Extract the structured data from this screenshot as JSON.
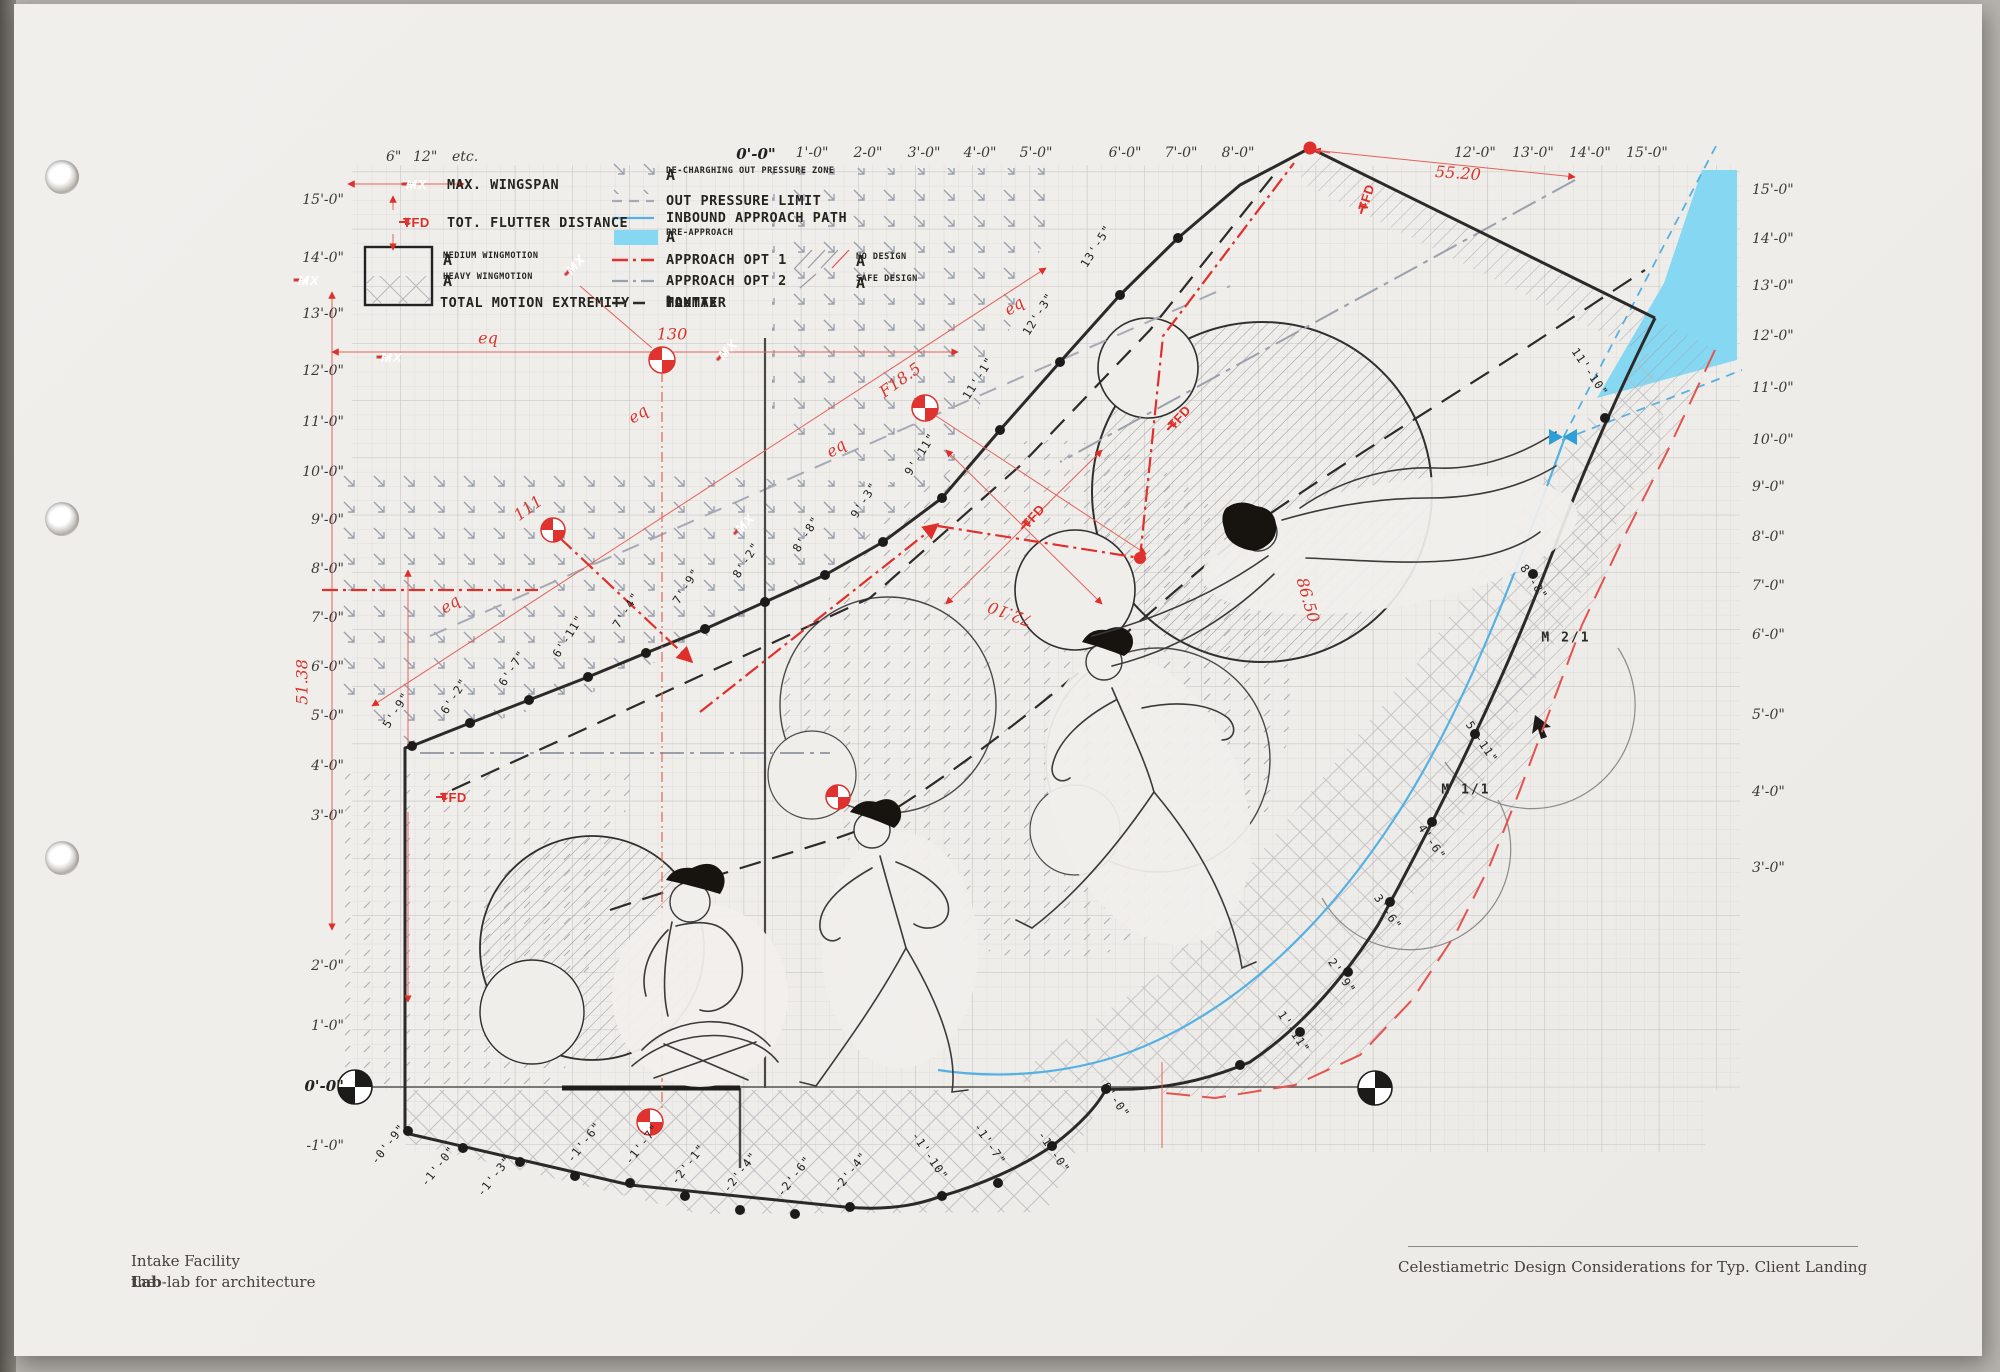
{
  "titleblock": {
    "project": "Intake Facility",
    "firm_prefix": "the",
    "firm_bold": "Lab",
    "firm_suffix": "-lab for architecture",
    "sheet_caption": "Celestiametric Design Considerations for Typ. Client Landing"
  },
  "legend": {
    "scale_note": [
      "6\"",
      "12\"",
      "etc."
    ],
    "stamp_mx": "MX",
    "stamp_tfd": "TFD",
    "tfd_arrow": "⇅",
    "arrow_left": "←",
    "arrow_right": "→",
    "rows_left": [
      {
        "label": "MAX. WINGSPAN"
      },
      {
        "label": "TOT. FLUTTER DISTANCE"
      },
      {
        "a": "A",
        "sub": "MEDIUM WINGMOTION"
      },
      {
        "a": "A",
        "sub": "HEAVY WINGMOTION"
      },
      {
        "label": "TOTAL MOTION EXTREMITY"
      }
    ],
    "rows_mid": [
      {
        "a": "A",
        "sub": "DE-CHARGHING OUT PRESSURE ZONE"
      },
      {
        "label": "OUT PRESSURE LIMIT"
      },
      {
        "label": "INBOUND APPROACH PATH"
      },
      {
        "a": "A",
        "sub": "PRE-APPROACH"
      },
      {
        "label": "APPROACH OPT 1"
      },
      {
        "label": "APPROACH OPT 2"
      }
    ],
    "flutter": {
      "p1": "MAX",
      "s1": "1",
      "p2": " TO MAX",
      "s2": "2",
      "p3": " FLUTTER"
    },
    "rows_right": [
      {
        "a": "A",
        "sub": "NO DESIGN"
      },
      {
        "a": "A",
        "sub": "SAFE DESIGN"
      }
    ]
  },
  "colors": {
    "red": "#df2f2a",
    "blue_line": "#55b1e4",
    "cyan_fill": "#86d7f2",
    "gray_dash": "#a6aab6",
    "ink": "#2c2b29"
  },
  "axes": {
    "top": [
      {
        "t": "0'-0\"",
        "x": 756,
        "b": true
      },
      {
        "t": "1'-0\"",
        "x": 812
      },
      {
        "t": "2-0\"",
        "x": 868
      },
      {
        "t": "3'-0\"",
        "x": 924
      },
      {
        "t": "4'-0\"",
        "x": 980
      },
      {
        "t": "5'-0\"",
        "x": 1036
      },
      {
        "t": "6'-0\"",
        "x": 1125
      },
      {
        "t": "7'-0\"",
        "x": 1181
      },
      {
        "t": "8'-0\"",
        "x": 1238
      },
      {
        "t": "12'-0\"",
        "x": 1475
      },
      {
        "t": "13'-0\"",
        "x": 1533
      },
      {
        "t": "14'-0\"",
        "x": 1590
      },
      {
        "t": "15'-0\"",
        "x": 1647
      }
    ],
    "left": [
      {
        "t": "15'-0\"",
        "y": 200
      },
      {
        "t": "14'-0\"",
        "y": 258
      },
      {
        "t": "13'-0\"",
        "y": 314
      },
      {
        "t": "12'-0\"",
        "y": 371
      },
      {
        "t": "11'-0\"",
        "y": 422
      },
      {
        "t": "10'-0\"",
        "y": 472
      },
      {
        "t": "9'-0\"",
        "y": 520
      },
      {
        "t": "8'-0\"",
        "y": 569
      },
      {
        "t": "7'-0\"",
        "y": 618
      },
      {
        "t": "6'-0\"",
        "y": 667
      },
      {
        "t": "5'-0\"",
        "y": 716
      },
      {
        "t": "4'-0\"",
        "y": 766
      },
      {
        "t": "3'-0\"",
        "y": 816
      },
      {
        "t": "2'-0\"",
        "y": 966
      },
      {
        "t": "1'-0\"",
        "y": 1026
      },
      {
        "t": "0'-0\"",
        "y": 1086,
        "b": true
      },
      {
        "t": "-1'-0\"",
        "y": 1146
      }
    ],
    "right": [
      {
        "t": "15'-0\"",
        "y": 190
      },
      {
        "t": "14'-0\"",
        "y": 239
      },
      {
        "t": "13'-0\"",
        "y": 286
      },
      {
        "t": "12'-0\"",
        "y": 336
      },
      {
        "t": "11'-0\"",
        "y": 388
      },
      {
        "t": "10'-0\"",
        "y": 440
      },
      {
        "t": "9'-0\"",
        "y": 487
      },
      {
        "t": "8'-0\"",
        "y": 537
      },
      {
        "t": "7'-0\"",
        "y": 586
      },
      {
        "t": "6'-0\"",
        "y": 635
      },
      {
        "t": "5'-0\"",
        "y": 715
      },
      {
        "t": "4'-0\"",
        "y": 792
      },
      {
        "t": "3'-0\"",
        "y": 868
      }
    ]
  },
  "annotations": [
    {
      "t": "55.20",
      "x": 1458,
      "y": 173,
      "r": 4,
      "c": "red"
    },
    {
      "t": "130",
      "x": 672,
      "y": 334,
      "r": 0,
      "c": "red"
    },
    {
      "t": "111",
      "x": 528,
      "y": 508,
      "r": -36,
      "c": "red"
    },
    {
      "t": "F18.5",
      "x": 900,
      "y": 380,
      "r": -36,
      "c": "red"
    },
    {
      "t": "72.10",
      "x": 1010,
      "y": 614,
      "r": 200,
      "c": "red"
    },
    {
      "t": "86.50",
      "x": 1308,
      "y": 600,
      "r": 74,
      "c": "red"
    },
    {
      "t": "51.38",
      "x": 302,
      "y": 682,
      "r": -90,
      "c": "red"
    },
    {
      "t": "eq",
      "x": 488,
      "y": 338,
      "r": 0,
      "c": "red"
    },
    {
      "t": "eq",
      "x": 638,
      "y": 414,
      "r": -33,
      "c": "red"
    },
    {
      "t": "eq",
      "x": 836,
      "y": 448,
      "r": -33,
      "c": "red"
    },
    {
      "t": "eq",
      "x": 1014,
      "y": 306,
      "r": -33,
      "c": "red"
    },
    {
      "t": "eq",
      "x": 450,
      "y": 604,
      "r": -33,
      "c": "red"
    },
    {
      "t": "5'-9\"",
      "x": 396,
      "y": 710,
      "r": -58,
      "c": "dim"
    },
    {
      "t": "6'-2\"",
      "x": 454,
      "y": 696,
      "r": -58,
      "c": "dim"
    },
    {
      "t": "6'-7\"",
      "x": 512,
      "y": 668,
      "r": -58,
      "c": "dim"
    },
    {
      "t": "6'-11\"",
      "x": 568,
      "y": 636,
      "r": -58,
      "c": "dim"
    },
    {
      "t": "7'-4\"",
      "x": 626,
      "y": 610,
      "r": -58,
      "c": "dim"
    },
    {
      "t": "7'-9\"",
      "x": 686,
      "y": 586,
      "r": -58,
      "c": "dim"
    },
    {
      "t": "8'-2\"",
      "x": 746,
      "y": 560,
      "r": -58,
      "c": "dim"
    },
    {
      "t": "8'-8\"",
      "x": 806,
      "y": 534,
      "r": -58,
      "c": "dim"
    },
    {
      "t": "9'-3\"",
      "x": 864,
      "y": 500,
      "r": -58,
      "c": "dim"
    },
    {
      "t": "9'-11\"",
      "x": 920,
      "y": 454,
      "r": -58,
      "c": "dim"
    },
    {
      "t": "11'-1\"",
      "x": 978,
      "y": 378,
      "r": -58,
      "c": "dim"
    },
    {
      "t": "12'-3\"",
      "x": 1038,
      "y": 314,
      "r": -58,
      "c": "dim"
    },
    {
      "t": "13'-5\"",
      "x": 1096,
      "y": 246,
      "r": -58,
      "c": "dim"
    },
    {
      "t": "11'-10\"",
      "x": 1590,
      "y": 372,
      "r": 56,
      "c": "dim"
    },
    {
      "t": "8'-8\"",
      "x": 1534,
      "y": 582,
      "r": 56,
      "c": "dim"
    },
    {
      "t": "5'-11\"",
      "x": 1482,
      "y": 742,
      "r": 56,
      "c": "dim"
    },
    {
      "t": "4'-6\"",
      "x": 1432,
      "y": 842,
      "r": 56,
      "c": "dim"
    },
    {
      "t": "3'-6\"",
      "x": 1388,
      "y": 912,
      "r": 56,
      "c": "dim"
    },
    {
      "t": "2'-9\"",
      "x": 1342,
      "y": 976,
      "r": 56,
      "c": "dim"
    },
    {
      "t": "1'-11\"",
      "x": 1294,
      "y": 1032,
      "r": 56,
      "c": "dim"
    },
    {
      "t": "0'-0\"",
      "x": 1116,
      "y": 1100,
      "r": 56,
      "c": "dim"
    },
    {
      "t": "-1'-0\"",
      "x": 1054,
      "y": 1152,
      "r": 56,
      "c": "dim"
    },
    {
      "t": "-1'-7\"",
      "x": 990,
      "y": 1144,
      "r": 56,
      "c": "dim"
    },
    {
      "t": "-1'-10\"",
      "x": 930,
      "y": 1156,
      "r": 56,
      "c": "dim"
    },
    {
      "t": "-0'-9\"",
      "x": 388,
      "y": 1144,
      "r": -52,
      "c": "dim"
    },
    {
      "t": "-1'-0\"",
      "x": 438,
      "y": 1166,
      "r": -52,
      "c": "dim"
    },
    {
      "t": "-1'-3\"",
      "x": 494,
      "y": 1176,
      "r": -52,
      "c": "dim"
    },
    {
      "t": "-1'-6\"",
      "x": 584,
      "y": 1142,
      "r": -52,
      "c": "dim"
    },
    {
      "t": "-1'-7\"",
      "x": 642,
      "y": 1144,
      "r": -52,
      "c": "dim"
    },
    {
      "t": "-2'-1\"",
      "x": 688,
      "y": 1164,
      "r": -52,
      "c": "dim"
    },
    {
      "t": "-2'-4\"",
      "x": 740,
      "y": 1172,
      "r": -52,
      "c": "dim"
    },
    {
      "t": "-2'-6\"",
      "x": 794,
      "y": 1176,
      "r": -52,
      "c": "dim"
    },
    {
      "t": "-2'-4\"",
      "x": 850,
      "y": 1172,
      "r": -52,
      "c": "dim"
    },
    {
      "t": "M 2/1",
      "x": 1566,
      "y": 638,
      "r": 0,
      "c": "m"
    },
    {
      "t": "M 1/1",
      "x": 1466,
      "y": 790,
      "r": 0,
      "c": "m"
    }
  ],
  "stamps": {
    "mx": [
      {
        "x": 406,
        "y": 184,
        "r": 0
      },
      {
        "x": 298,
        "y": 280,
        "r": 0
      },
      {
        "x": 381,
        "y": 357,
        "r": 0
      },
      {
        "x": 568,
        "y": 272,
        "r": -47
      },
      {
        "x": 720,
        "y": 357,
        "r": -47
      },
      {
        "x": 737,
        "y": 531,
        "r": -47
      }
    ],
    "tfd": [
      {
        "x": 403,
        "y": 222,
        "r": 0
      },
      {
        "x": 440,
        "y": 797,
        "r": 0
      },
      {
        "x": 1024,
        "y": 526,
        "r": -48
      },
      {
        "x": 1170,
        "y": 427,
        "r": -48
      },
      {
        "x": 1362,
        "y": 210,
        "r": -73
      }
    ]
  }
}
